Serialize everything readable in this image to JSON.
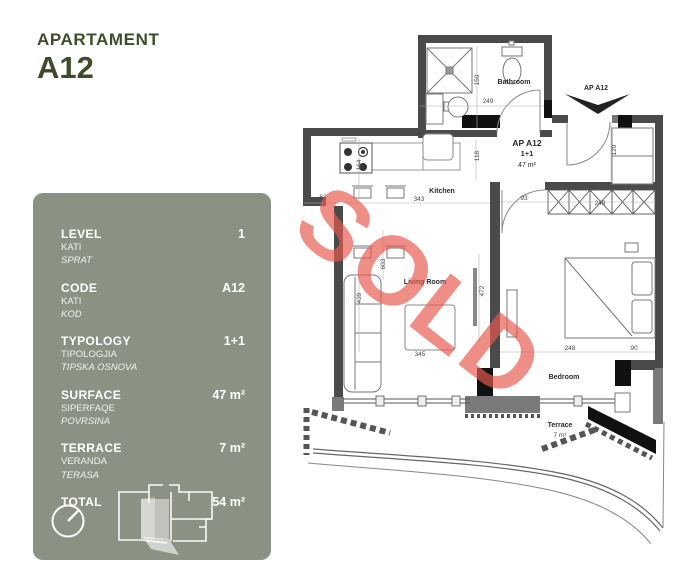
{
  "header": {
    "title": "APARTAMENT",
    "code": "A12"
  },
  "panel": {
    "rows": [
      {
        "label": "LEVEL",
        "sub1": "KATI",
        "sub2": "SPRAT",
        "value": "1"
      },
      {
        "label": "CODE",
        "sub1": "KATI",
        "sub2": "KOD",
        "value": "A12"
      },
      {
        "label": "TYPOLOGY",
        "sub1": "TIPOLOGJIA",
        "sub2": "TIPSKA OSNOVA",
        "value": "1+1"
      },
      {
        "label": "SURFACE",
        "sub1": "SIPERFAQE",
        "sub2": "POVRSINA",
        "value": "47 m²"
      },
      {
        "label": "TERRACE",
        "sub1": "VERANDA",
        "sub2": "TERASA",
        "value": "7 m²"
      },
      {
        "label": "TOTAL",
        "sub1": "",
        "sub2": "",
        "value": "54 m²"
      }
    ]
  },
  "floorplan": {
    "watermark": "SOLD",
    "entry_label": "AP A12",
    "unit": {
      "name": "AP A12",
      "typology": "1+1",
      "area": "47 m²"
    },
    "rooms": {
      "bathroom": "Bathroom",
      "kitchen": "Kitchen",
      "living": "Living Room",
      "bedroom": "Bedroom",
      "terrace": "Terrace",
      "terrace_area": "7 m²"
    },
    "dims": {
      "bathroom_height": "150",
      "bathroom_width": "249",
      "kitchen_depth": "164",
      "wall_jog": "63",
      "kitchen_width": "343",
      "passage": "118",
      "entry_door": "120",
      "wardrobe_width": "249",
      "bedroom_door": "93",
      "living_length": "603",
      "sofa_length": "439",
      "living_wall": "472",
      "living_width": "345",
      "bedroom_width": "248",
      "bedroom_side": "90"
    }
  },
  "colors": {
    "header_green": "#3E4D28",
    "panel_bg": "#8B9283",
    "watermark_red": "#E85A4D",
    "wall_dark": "#4A4A4A"
  }
}
